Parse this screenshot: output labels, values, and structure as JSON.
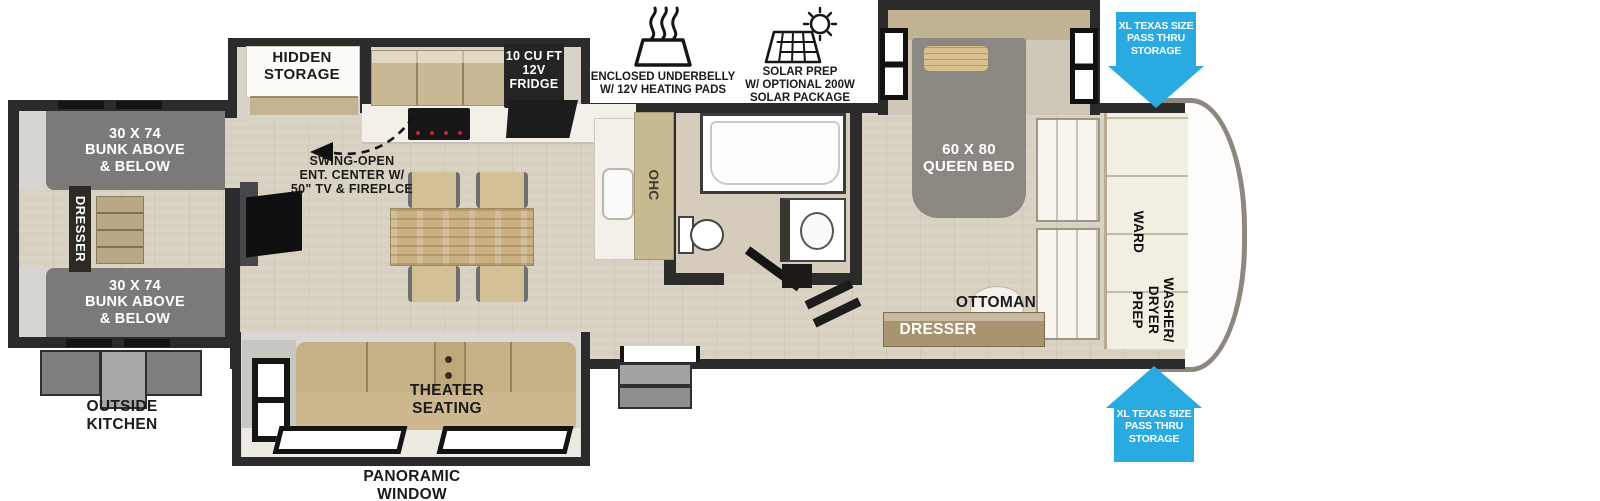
{
  "exterior": {
    "underbelly": "ENCLOSED UNDERBELLY\nW/ 12V HEATING PADS",
    "solar": "SOLAR PREP\nW/ OPTIONAL 200W\nSOLAR PACKAGE",
    "pass_thru_top": "XL TEXAS SIZE\nPASS THRU\nSTORAGE",
    "pass_thru_bottom": "XL TEXAS SIZE\nPASS THRU\nSTORAGE",
    "outside_kitchen": "OUTSIDE\nKITCHEN",
    "panoramic_window": "PANORAMIC\nWINDOW"
  },
  "bunk_room": {
    "bunk_top": "30 X 74\nBUNK ABOVE\n& BELOW",
    "bunk_bottom": "30 X 74\nBUNK ABOVE\n& BELOW",
    "dresser": "DRESSER"
  },
  "kitchen": {
    "hidden_storage": "HIDDEN\nSTORAGE",
    "fridge": "10 CU FT\n12V\nFRIDGE",
    "ohc": "OHC",
    "ent_center": "SWING-OPEN\nENT. CENTER W/\n50\" TV & FIREPLCE"
  },
  "living": {
    "theater_seating": "THEATER\nSEATING"
  },
  "bedroom": {
    "queen_bed": "60 X 80\nQUEEN BED",
    "ottoman": "OTTOMAN",
    "dresser": "DRESSER",
    "ward": "WARD",
    "washer_dryer_prep": "WASHER/\nDRYER\nPREP"
  },
  "colors": {
    "wall": "#2b2b2b",
    "accent_blue": "#29abe2",
    "bunk_gray": "#7b7a78",
    "bed_gray": "#8a8880",
    "floor_wood": "#d8d1c2",
    "cabinet_tan": "#cab995",
    "counter_white": "#f2f0e9"
  }
}
